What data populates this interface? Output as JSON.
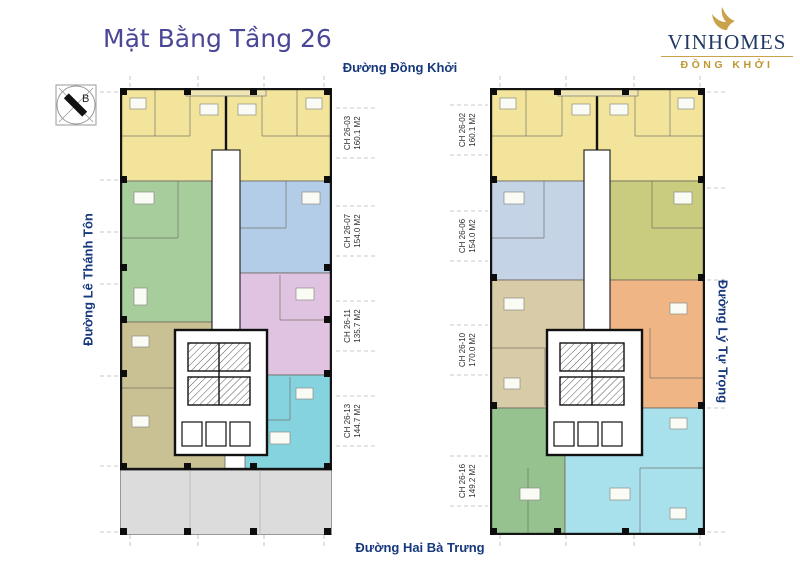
{
  "page": {
    "title": "Mặt Bằng Tầng 26"
  },
  "logo": {
    "brand": "VINHOMES",
    "sub": "ĐỒNG KHỞI"
  },
  "compass": {
    "north_label": "B"
  },
  "streets": {
    "top": "Đường Đồng Khởi",
    "bottom": "Đường Hai Bà Trưng",
    "left": "Đường Lê Thánh Tôn",
    "right": "Đường Lý Tự Trọng"
  },
  "buildings": [
    {
      "name": "left-tower",
      "units": [
        {
          "id": "CH 26-03",
          "area": "160.1 M2",
          "color_key": "yellow"
        },
        {
          "id": "CH 26-07",
          "area": "154.0 M2",
          "color_key": "blue_l"
        },
        {
          "id": "CH 26-11",
          "area": "135.7 M2",
          "color_key": "pink_l"
        },
        {
          "id": "CH 26-13",
          "area": "144.7 M2",
          "color_key": "cyan_l"
        }
      ]
    },
    {
      "name": "right-tower",
      "units": [
        {
          "id": "CH 26-02",
          "area": "160.1 M2",
          "color_key": "yellow"
        },
        {
          "id": "CH 26-06",
          "area": "154.0 M2",
          "color_key": "olivegreen_r"
        },
        {
          "id": "CH 26-10",
          "area": "170.0 M2",
          "color_key": "orange_r"
        },
        {
          "id": "CH 26-16",
          "area": "149.2 M2",
          "color_key": "cyan_r"
        }
      ]
    }
  ],
  "palette": {
    "yellow": "#F2E49B",
    "green_l": "#A6CD9B",
    "blue_l": "#B3CCE8",
    "pink_l": "#E0C3E0",
    "olive_l": "#C9C093",
    "cyan_l": "#85D3DF",
    "bluegray_r": "#C4D3E6",
    "olivegreen_r": "#C9CB7F",
    "beige_r": "#D8CBA8",
    "orange_r": "#F0B584",
    "green_r": "#95C28F",
    "cyan_r": "#A8E1EC",
    "podium": "#DCDCDC"
  },
  "text_colors": {
    "title": "#4A4798",
    "street": "#16387C",
    "brand_navy": "#203864",
    "brand_gold": "#BE9730"
  }
}
